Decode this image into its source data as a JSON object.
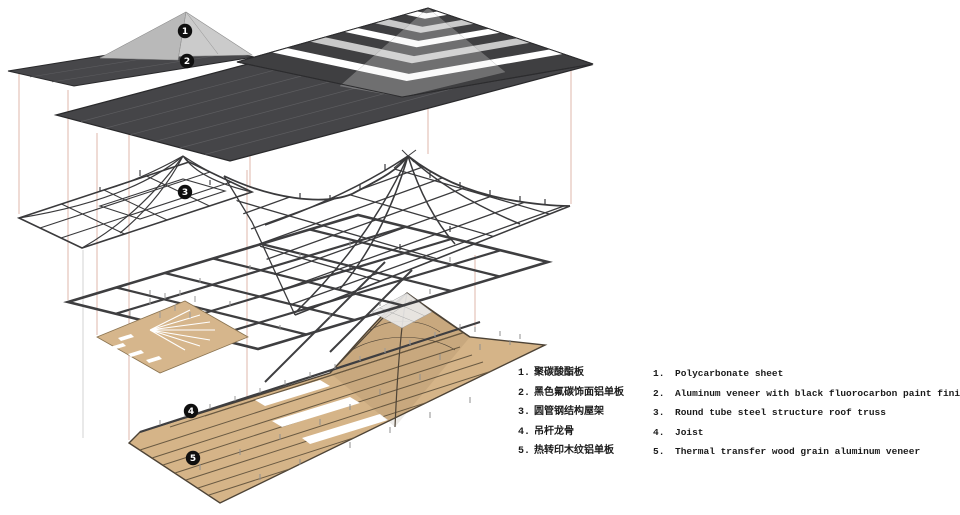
{
  "figure": {
    "type": "exploded-axonometric-construction-diagram",
    "badges": [
      {
        "label": "1"
      },
      {
        "label": "2"
      },
      {
        "label": "3"
      },
      {
        "label": "4"
      },
      {
        "label": "5"
      }
    ],
    "colors": {
      "roof_dark": "#454548",
      "panel_light": "#c9c9c9",
      "steel": "#3b3b3d",
      "wood": "#d5b488",
      "wood_seam": "#6a5a42",
      "connector_pink": "#dcb0a2",
      "badge_bg": "#0f0f0f"
    }
  },
  "legend": {
    "items": [
      {
        "no": "1.",
        "zh": "聚碳酸酯板",
        "en": "Polycarbonate sheet"
      },
      {
        "no": "2.",
        "zh": "黑色氟碳饰面铝单板",
        "en": "Aluminum veneer with black fluorocarbon paint finish"
      },
      {
        "no": "3.",
        "zh": "圆管钢结构屋架",
        "en": "Round tube steel structure roof truss"
      },
      {
        "no": "4.",
        "zh": "吊杆龙骨",
        "en": "Joist"
      },
      {
        "no": "5.",
        "zh": "热转印木纹铝单板",
        "en": "Thermal transfer wood grain aluminum veneer"
      }
    ]
  }
}
